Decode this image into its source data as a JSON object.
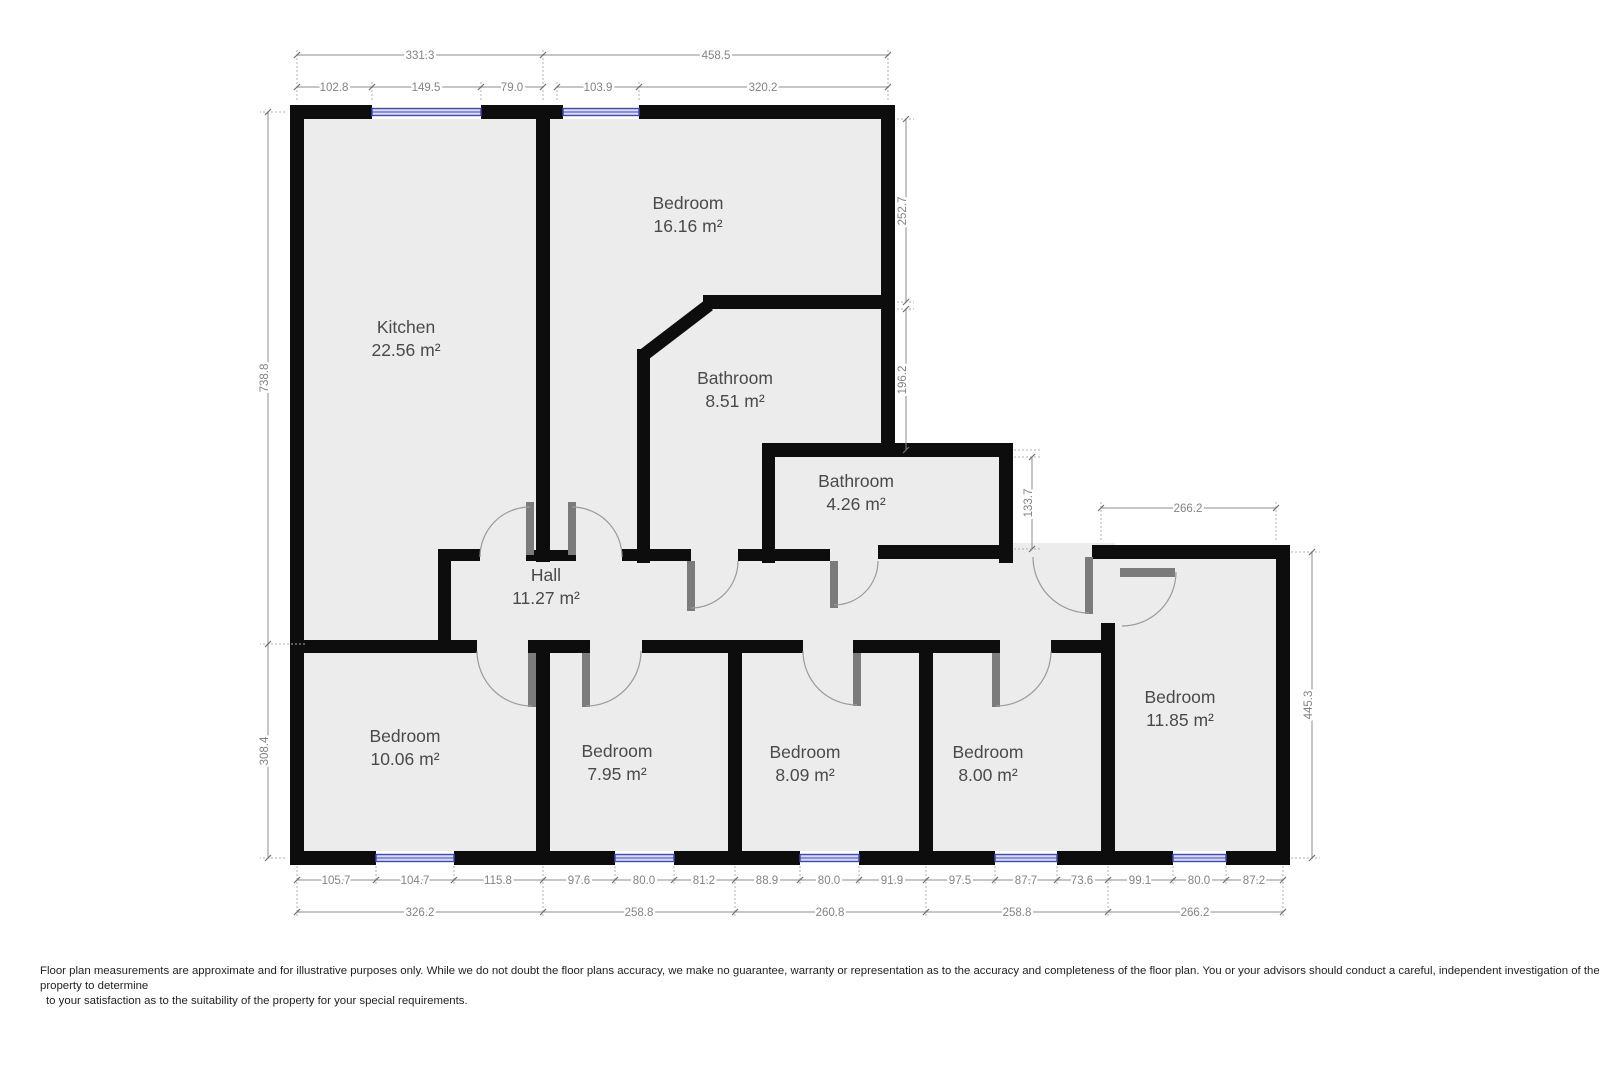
{
  "rooms": [
    {
      "id": "kitchen",
      "name": "Kitchen",
      "area": "22.56 m²"
    },
    {
      "id": "bedroom-1",
      "name": "Bedroom",
      "area": "16.16 m²"
    },
    {
      "id": "bathroom-1",
      "name": "Bathroom",
      "area": "8.51 m²"
    },
    {
      "id": "bathroom-2",
      "name": "Bathroom",
      "area": "4.26 m²"
    },
    {
      "id": "hall",
      "name": "Hall",
      "area": "11.27 m²"
    },
    {
      "id": "bedroom-2",
      "name": "Bedroom",
      "area": "10.06 m²"
    },
    {
      "id": "bedroom-3",
      "name": "Bedroom",
      "area": "7.95 m²"
    },
    {
      "id": "bedroom-4",
      "name": "Bedroom",
      "area": "8.09 m²"
    },
    {
      "id": "bedroom-5",
      "name": "Bedroom",
      "area": "8.00 m²"
    },
    {
      "id": "bedroom-6",
      "name": "Bedroom",
      "area": "11.85 m²"
    }
  ],
  "dims": {
    "top": [
      "331.3",
      "458.5"
    ],
    "top_detail": [
      "102.8",
      "149.5",
      "79.0",
      "103.9",
      "320.2"
    ],
    "left": [
      "738.8",
      "308.4"
    ],
    "right_top": [
      "252.7",
      "196.2",
      "133.7"
    ],
    "right_bedroom": [
      "266.2",
      "445.3"
    ],
    "bottom_detail": [
      "105.7",
      "104.7",
      "115.8",
      "97.6",
      "80.0",
      "81.2",
      "88.9",
      "80.0",
      "91.9",
      "97.5",
      "87.7",
      "73.6",
      "99.1",
      "80.0",
      "87.2"
    ],
    "bottom": [
      "326.2",
      "258.8",
      "260.8",
      "258.8",
      "266.2"
    ]
  },
  "colors": {
    "wall": "#0d0d0d",
    "floor": "#ececec",
    "window_accent": "#3f49ae",
    "dimension_text": "#838383"
  },
  "disclaimer": {
    "line1": "Floor plan measurements are approximate and for illustrative purposes only. While we do not doubt the floor plans accuracy, we make no guarantee, warranty or representation as to the accuracy and completeness of the floor plan. You or your advisors should conduct a careful, independent investigation of the",
    "line2": "property to determine",
    "line3": "to your satisfaction as to the suitability of the property for your special requirements."
  }
}
